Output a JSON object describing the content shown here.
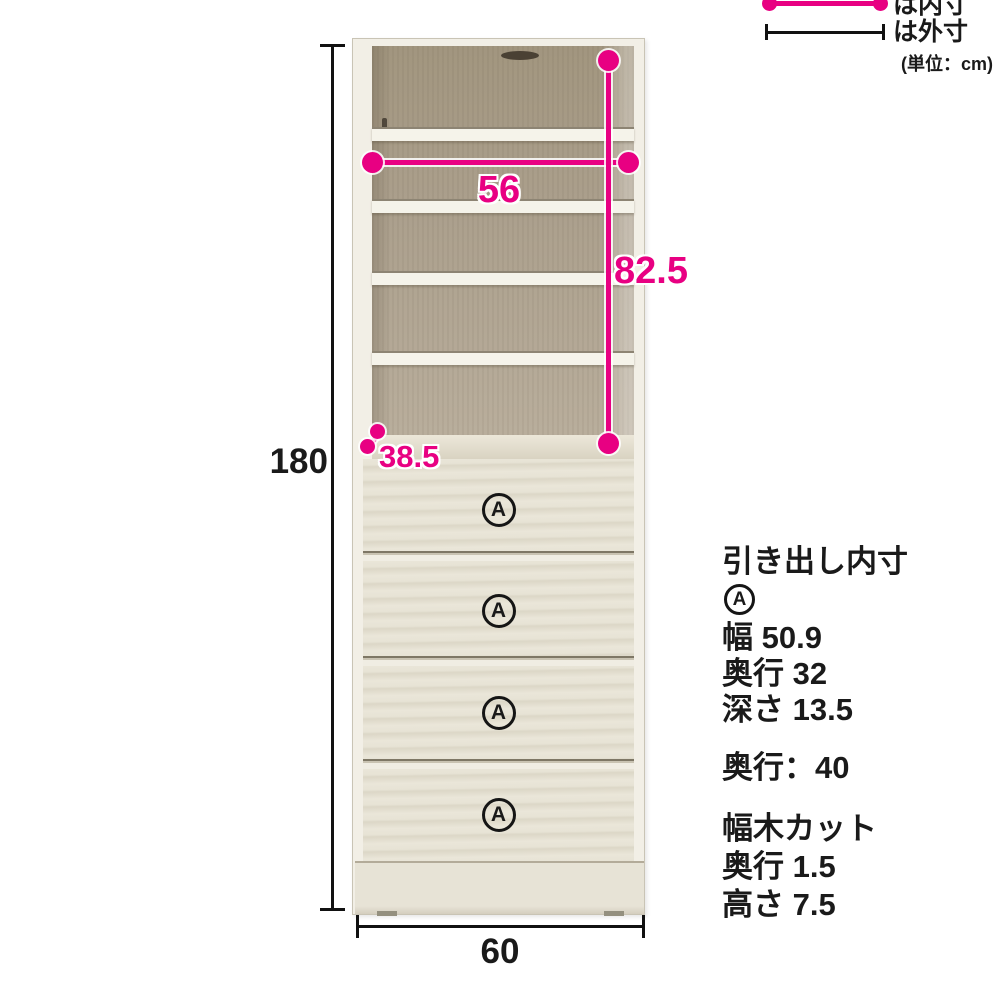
{
  "colors": {
    "accent_pink": "#e80082",
    "ink_black": "#1a1a1a",
    "cabinet_cream": "#f2efe6",
    "interior_taupe": "#a99d8a"
  },
  "legend": {
    "inner_label": "は内寸",
    "outer_label": "は外寸",
    "unit_label": "(単位：cm)"
  },
  "dims": {
    "outer_height": "180",
    "outer_width": "60",
    "inner_width": "56",
    "inner_height": "82.5",
    "inner_depth": "38.5"
  },
  "drawer_labels": [
    "A",
    "A",
    "A",
    "A"
  ],
  "spec": {
    "title": "引き出し内寸",
    "marker": "A",
    "items": [
      "幅 50.9",
      "奥行 32",
      "深さ 13.5"
    ],
    "depth_line": "奥行：40",
    "baseboard": {
      "title": "幅木カット",
      "items": [
        "奥行 1.5",
        "高さ 7.5"
      ]
    }
  }
}
